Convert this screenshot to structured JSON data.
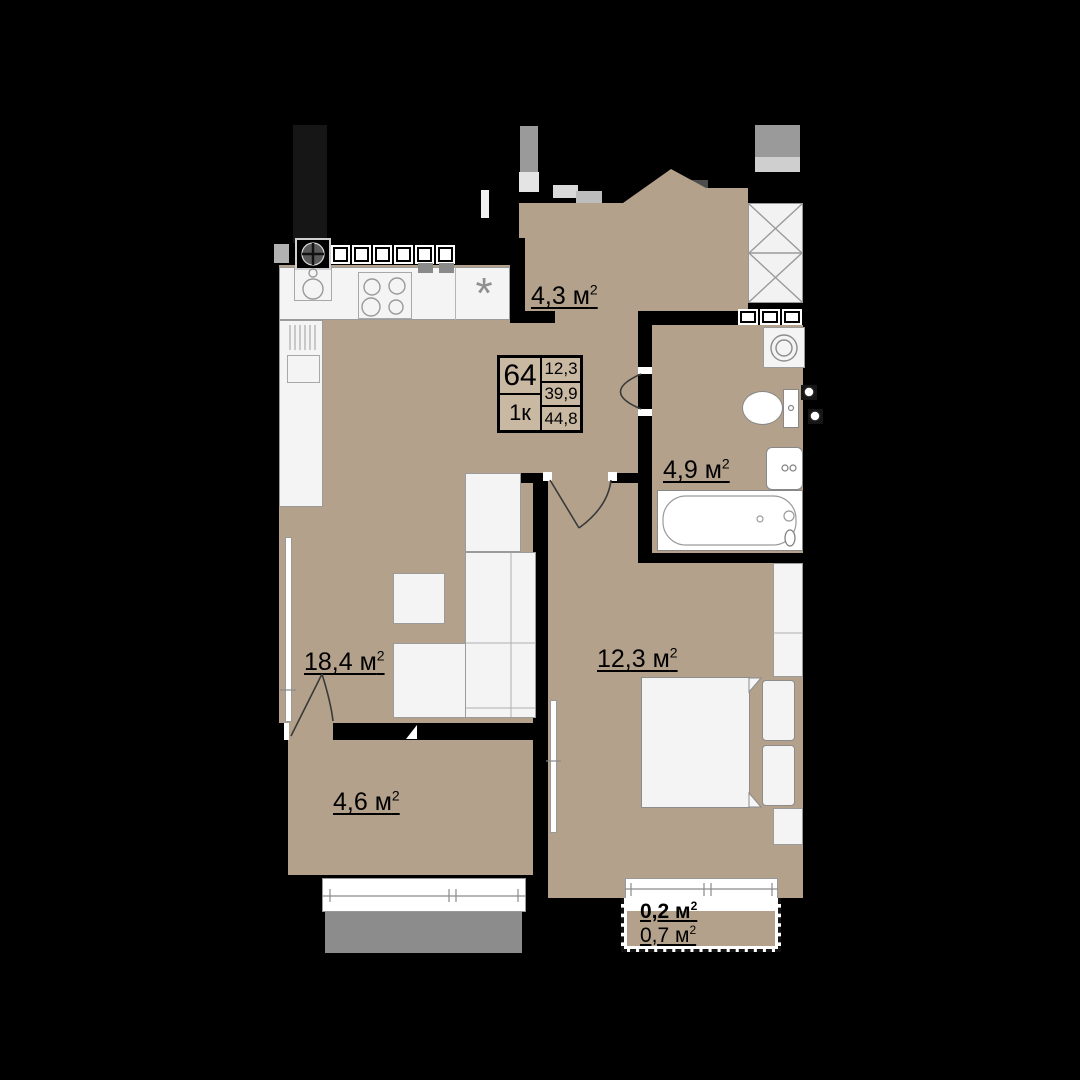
{
  "info_box": {
    "number": "64",
    "type": "1к",
    "areas": [
      "12,3",
      "39,9",
      "44,8"
    ]
  },
  "rooms": [
    {
      "key": "hallway",
      "label": "4,3 м",
      "sup": "2"
    },
    {
      "key": "bathroom",
      "label": "4,9 м",
      "sup": "2"
    },
    {
      "key": "living_kitchen",
      "label": "18,4 м",
      "sup": "2"
    },
    {
      "key": "bedroom",
      "label": "12,3 м",
      "sup": "2"
    },
    {
      "key": "storage",
      "label": "4,6 м",
      "sup": "2"
    },
    {
      "key": "balcony_small",
      "label": "0,2 м",
      "sup": "2"
    },
    {
      "key": "balcony",
      "label": "0,7 м",
      "sup": "2"
    }
  ],
  "symbols": {
    "dishwasher": "*"
  },
  "colors": {
    "floor": "#b3a18b",
    "cell": "#c9b9a2",
    "furn": "#f4f4f4",
    "terrace": "#8c8c8c",
    "wall": "#000000"
  }
}
